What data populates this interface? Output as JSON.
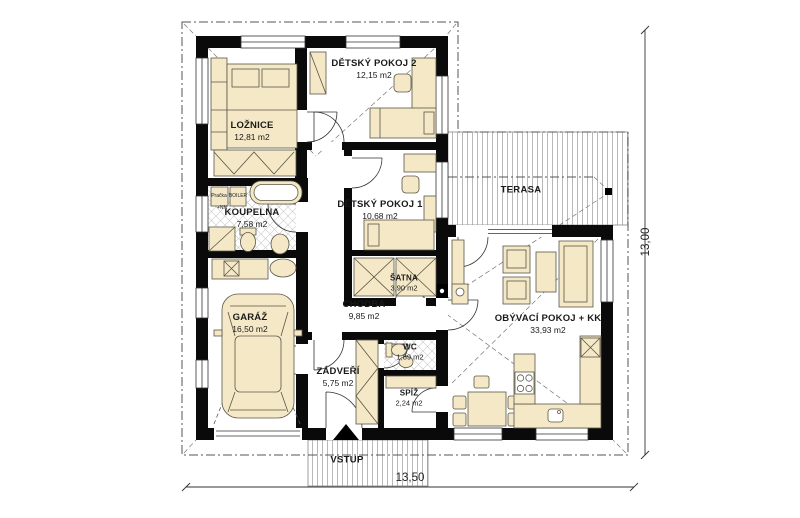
{
  "plan": {
    "rooms": [
      {
        "name": "LOŽNICE",
        "area": "12,81 m2"
      },
      {
        "name": "DĚTSKÝ POKOJ 2",
        "area": "12,15 m2"
      },
      {
        "name": "DĚTSKÝ POKOJ 1",
        "area": "10,68 m2"
      },
      {
        "name": "KOUPELNA",
        "area": "7,58 m2"
      },
      {
        "name": "GARÁŽ",
        "area": "16,50 m2"
      },
      {
        "name": "ŠATNA",
        "area": "3,90 m2"
      },
      {
        "name": "CHODBA",
        "area": "9,85 m2"
      },
      {
        "name": "ZÁDVEŘÍ",
        "area": "5,75 m2"
      },
      {
        "name": "WC",
        "area": "1,89 m2"
      },
      {
        "name": "SPÍŽ",
        "area": "2,24 m2"
      },
      {
        "name": "OBÝVACÍ POKOJ + KK",
        "area": "33,93 m2"
      }
    ],
    "outdoor": {
      "terrace_label": "TERASA",
      "entrance_label": "VSTUP"
    },
    "equipment": {
      "washer_label": "Pračka",
      "boiler_label": "BOILER",
      "electrical_note": "+NN"
    },
    "dimensions": {
      "overall_width_m": "13,50",
      "overall_height_m": "13,00"
    },
    "colors": {
      "wall": "#0a0a0a",
      "furniture_fill": "#f4e8c6",
      "furniture_outline": "#5a5648",
      "hatch_line": "#9a9a9a",
      "roof_line": "#555555"
    }
  }
}
